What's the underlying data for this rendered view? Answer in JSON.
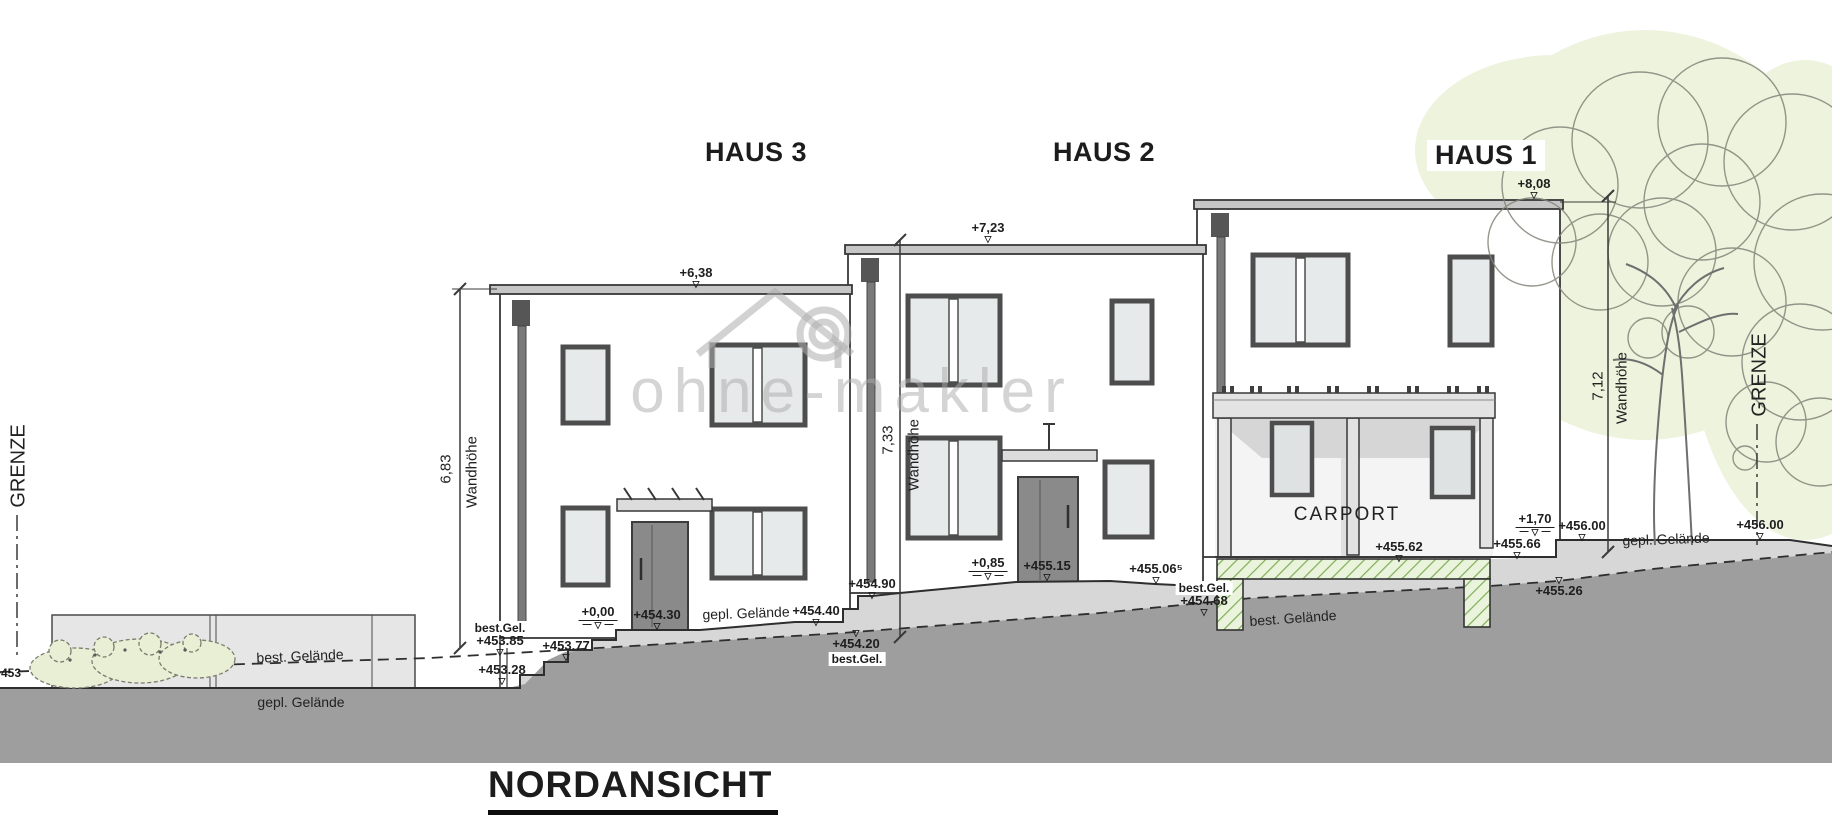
{
  "drawing": {
    "title": "NORDANSICHT",
    "watermark": "ohne-makler",
    "boundary": {
      "left": "GRENZE",
      "right": "GRENZE"
    },
    "houses": {
      "haus3": {
        "name": "HAUS 3",
        "roof_level": "+6,38",
        "dim_value": "6,83",
        "dim_label": "Wandhöhe"
      },
      "haus2": {
        "name": "HAUS 2",
        "roof_level": "+7,23",
        "dim_value": "7,33",
        "dim_label": "Wandhöhe"
      },
      "haus1": {
        "name": "HAUS 1",
        "roof_level": "+8,08",
        "dim_value": "7,12",
        "dim_label": "Wandhöhe",
        "carport": "CARPORT"
      }
    },
    "levels": {
      "h3_zero": "+0,00",
      "h3_entry": "+454.30",
      "h3_454_40": "+454.40",
      "h3_best_gel": "best.Gel.",
      "h3_453_85": "+453.85",
      "h3_453_77": "+453.77",
      "h3_453_28": "+453.28",
      "h2_454_20": "+454.20",
      "h2_best_gel": "best.Gel.",
      "h2_454_90": "+454.90",
      "h2_zero": "+0,85",
      "h2_entry": "+455.15",
      "h2_455_06": "+455.06⁵",
      "h2_best_gel_2": "best.Gel.",
      "h2_454_68": "+454.68",
      "carport_455_62": "+455.62",
      "carport_455_66": "+455.66",
      "carport_1_70": "+1,70",
      "carport_456_00": "+456.00",
      "right_455_26": "+455.26",
      "right_456_00": "+456.00"
    },
    "terrain": {
      "best_gelaende_left": "best. Gelände",
      "gepl_gelaende_left": "gepl. Gelände",
      "gepl_gelaende_mid": "gepl. Gelände",
      "best_gelaende_mid": "best. Gelände",
      "gepl_gelaende_right": "gepl. Gelände",
      "partial_453": "+453"
    },
    "icons": {
      "level_marker": "▽"
    },
    "colors": {
      "ground_dark": "#9e9e9e",
      "ground_light": "#d7d7d7",
      "roof_slab": "#c6c6c6",
      "foundation_green_fill": "#eaf3db",
      "foundation_green_hatch": "#7fae5a",
      "tree_green": "#edf3dc",
      "line": "#2e2e2e",
      "watermark_gray": "#aaaaaa"
    }
  }
}
